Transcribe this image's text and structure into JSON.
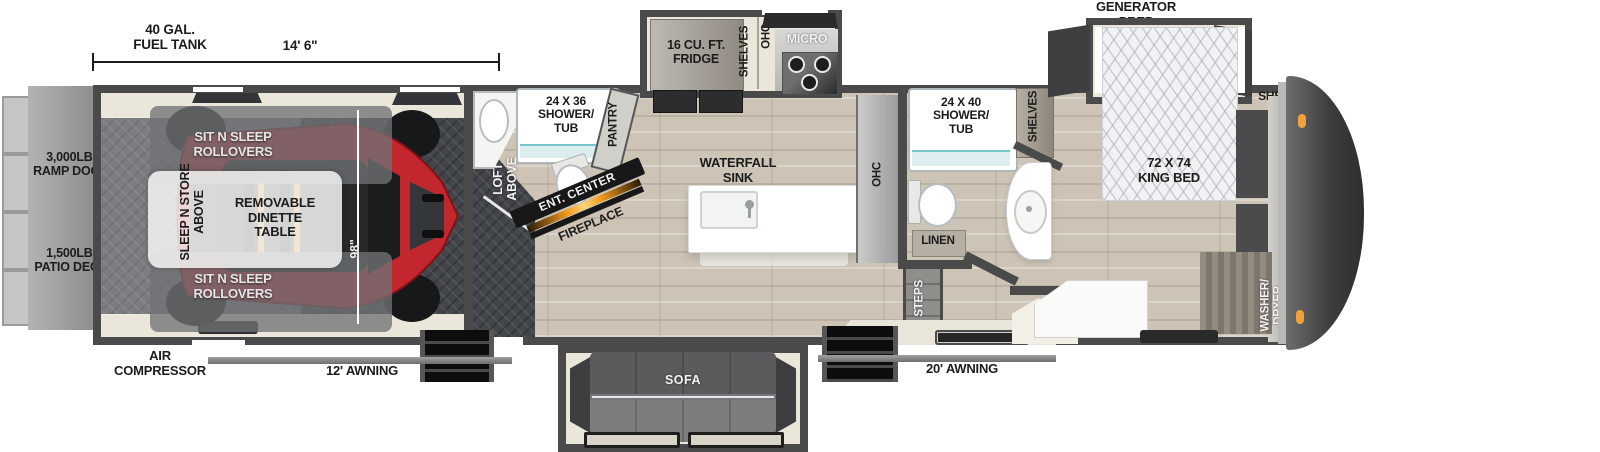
{
  "title": "Toy hauler fifth wheel floorplan",
  "colors": {
    "wall": "#4a4a4a",
    "wood_floor": "#cdc4b6",
    "garage_floor": "#42464b",
    "slide_floor": "#eae6d9",
    "atv_red": "#c1272d",
    "awning": "#8a8a8a",
    "marker_light": "#f0a13c",
    "fireplace_amber": "#f29a1d"
  },
  "dimensions": {
    "fuel_tank": "40 GAL.\nFUEL TANK",
    "garage_length": "14' 6\"",
    "ramp_depth": "96\"",
    "garage_width": "98\""
  },
  "exterior": {
    "ramp_door": "3,000LB.\nRAMP DOOR",
    "patio_deck": "1,500LB.\nPATIO DECK",
    "air_compressor": "AIR\nCOMPRESSOR",
    "awning_garage": "12' AWNING",
    "awning_main": "20' AWNING",
    "generator_prep": "GENERATOR\nPREP"
  },
  "garage": {
    "rollover_sofa_top": "SIT N SLEEP\nROLLOVERS",
    "rollover_sofa_bottom": "SIT N SLEEP\nROLLOVERS",
    "sleep_n_store": "SLEEP N STORE\nABOVE",
    "dinette": "REMOVABLE\nDINETTE\nTABLE",
    "loft": "LOFT\nABOVE"
  },
  "half_bath": {
    "shower": "24 X 36\nSHOWER/\nTUB",
    "pantry": "PANTRY"
  },
  "living": {
    "ent_center": "ENT. CENTER",
    "fireplace": "FIREPLACE",
    "sofa": "SOFA"
  },
  "kitchen": {
    "fridge": "16 CU. FT.\nFRIDGE",
    "shelves": "SHELVES",
    "ohc_top": "OHC",
    "micro": "MICRO",
    "waterfall_sink": "WATERFALL\nSINK",
    "ohc_side": "OHC"
  },
  "main_bath": {
    "shower": "24 X 40\nSHOWER/\nTUB",
    "shelves": "SHELVES",
    "linen": "LINEN",
    "steps": "STEPS"
  },
  "bedroom": {
    "king_bed": "72 X 74\nKING BED",
    "shelves": "SHELVES",
    "ward": "WARD",
    "washer_dryer": "WASHER/\nDRYER\nPREP"
  }
}
